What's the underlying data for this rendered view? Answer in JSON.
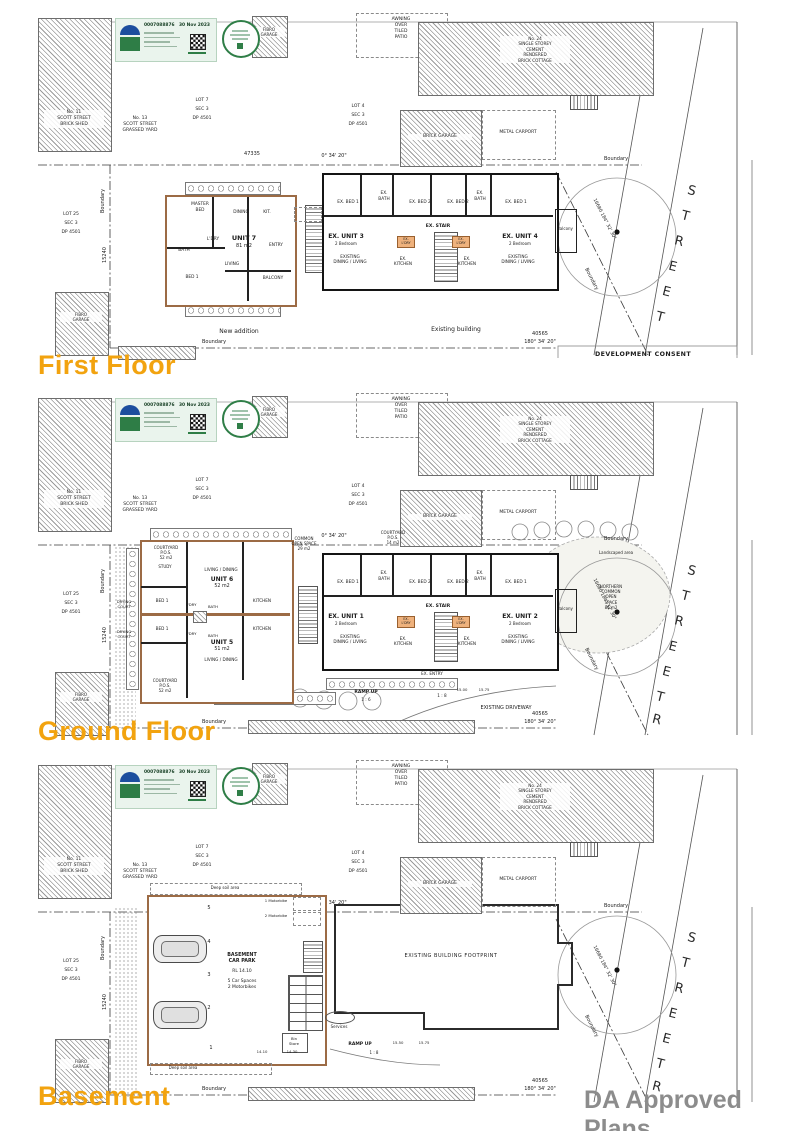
{
  "headings": {
    "first": "First Floor",
    "ground": "Ground Floor",
    "basement": "Basement",
    "watermark": "DA Approved Plans"
  },
  "colors": {
    "accent_orange": "#F2A30F",
    "watermark_gray": "#8C8C8C",
    "cert_green": "#2E7D46",
    "new_wall_brown": "#9C6B45"
  },
  "cert": {
    "number": "0007088876",
    "date": "30 Nov 2023"
  },
  "site": {
    "shed": "No. 11\nSCOTT STREET\nBRICK SHED",
    "grassed": "No. 13\nSCOTT STREET\nGRASSED YARD",
    "lot7": "LOT 7\nSEC 3\nDP 4501",
    "lot4": "LOT 4\nSEC 3\nDP 4501",
    "lot25": "LOT 25\nSEC 3\nDP 4501",
    "fibro": "FIBRO\nGARAGE",
    "awning": "AWNING\nOVER\nTILED\nPATIO",
    "cottage": "No. 24\nSINGLE STOREY\nCEMENT\nRENDERED\nBRICK COTTAGE",
    "carport": "METAL CARPORT",
    "garage": "BRICK GARAGE",
    "boundary": "Boundary",
    "dim_top": "47335",
    "brg_top": "0° 34' 20\"",
    "dim_bot": "40565",
    "brg_bot": "180° 34' 20\"",
    "dim_left": "15240",
    "brg_left": "90° 37' 20\"",
    "dim_diag": "16680",
    "brg_diag": "184° 32' 30\"",
    "street": "S\nT\nR\nE\nE\nT",
    "street_r": "R",
    "consent": "DEVELOPMENT CONSENT"
  },
  "ex": {
    "bed1": "EX. BED 1",
    "bed2": "EX. BED 2",
    "bath": "EX.\nBATH",
    "stair": "EX. STAIR",
    "kitchen": "EX.\nKITCHEN",
    "laundry": "EX.\nL'DRY",
    "dining": "EXISTING\nDINING / LIVING",
    "two_bed": "2 Bedroom",
    "balcony": "Balcony",
    "entry": "EX. ENTRY"
  },
  "first": {
    "unit": "UNIT 7",
    "area": "81 m2",
    "master": "MASTER\nBED",
    "bath": "BATH",
    "bed1": "BED 1",
    "dining": "DINING",
    "kit": "KIT.",
    "ldry": "L'DRY",
    "entry": "ENTRY",
    "living": "LIVING",
    "balcony": "BALCONY",
    "unit3": "EX. UNIT 3",
    "unit4": "EX. UNIT 4",
    "new_addition": "New addition",
    "existing": "Existing building"
  },
  "ground": {
    "unit6": "UNIT 6",
    "unit6_area": "52 m2",
    "unit5": "UNIT 5",
    "unit5_area": "51 m2",
    "living_dining": "LIVING / DINING",
    "kitchen": "KITCHEN",
    "bed1": "BED 1",
    "bath": "BATH",
    "ldry": "L'DRY",
    "study": "STUDY",
    "courtyard52": "COURTYARD\nP.O.S.\n52 m2",
    "courtyard14": "COURTYARD\nP.O.S.\n14 m2",
    "common": "COMMON\nOPEN SPACE\n29 m2",
    "drying": "DRYING\nCOURT",
    "unit1": "EX. UNIT 1",
    "unit2": "EX. UNIT 2",
    "ramp": "RAMP UP",
    "grade6": "1 : 6",
    "grade8": "1 : 8",
    "lvl1": "15.00",
    "lvl2": "15.75",
    "driveway": "EXISTING DRIVEWAY",
    "landscaped": "Landscaped area",
    "northern": "NORTHERN\nCOMMON\nOPEN\nSPACE\n86 m2"
  },
  "basement": {
    "title": "BASEMENT\nCAR PARK",
    "rl": "RL 14.10",
    "spaces": "5 Car Spaces\n2 Motorbikes",
    "moto1": "1 Motorbike",
    "moto2": "2 Motorbike",
    "bin": "Bin\nStore",
    "services": "Services",
    "ramp": "RAMP UP",
    "grade8": "1 : 8",
    "deep": "Deep soil area",
    "footprint": "EXISTING BUILDING FOOTPRINT",
    "n1": "1",
    "n2": "2",
    "n3": "3",
    "n4": "4",
    "n5": "5",
    "lv1": "14.10",
    "lv2": "14.30",
    "lv3": "15.50",
    "lv4": "15.75"
  }
}
